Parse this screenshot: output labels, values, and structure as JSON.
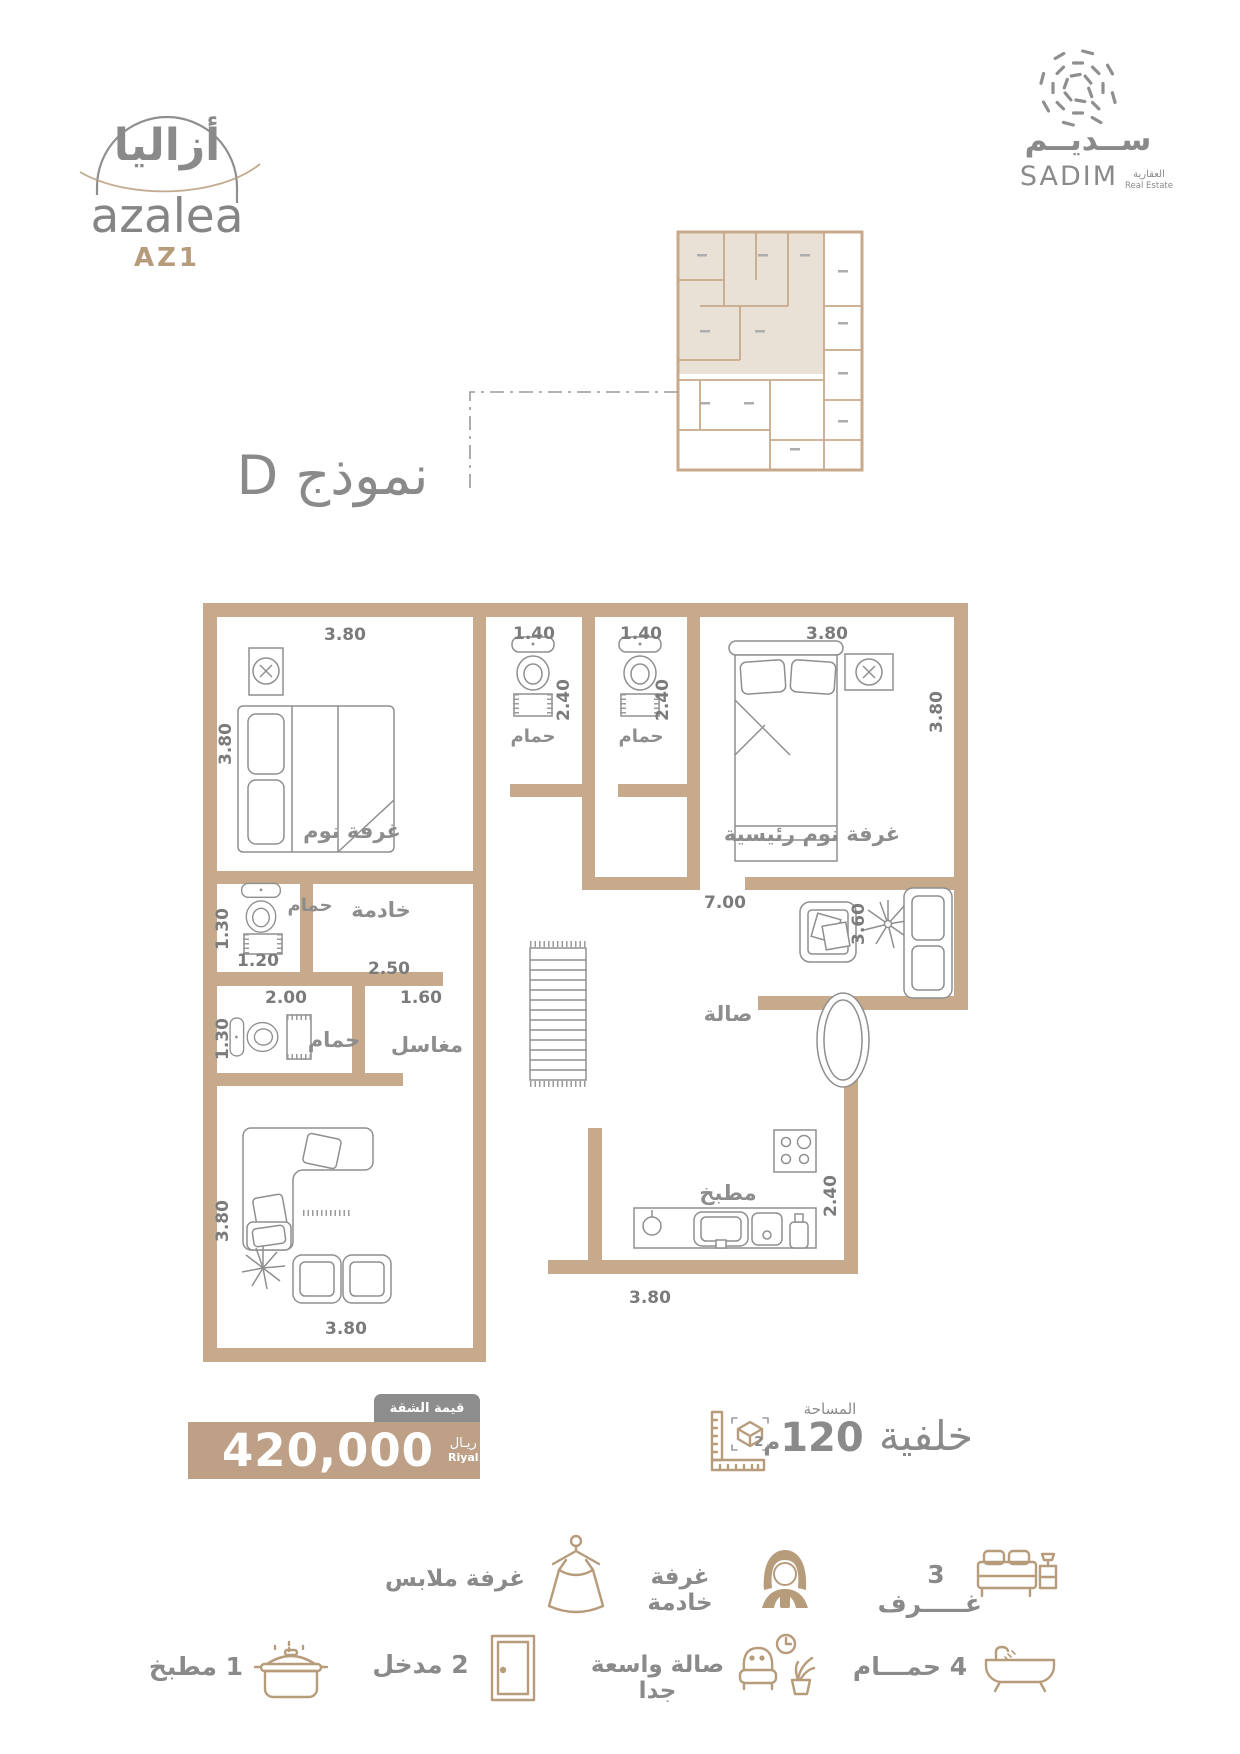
{
  "colors": {
    "wall": "#c7a98b",
    "accent": "#b79c7c",
    "text_gray": "#8a8a8a",
    "highlight": "#e9e1d5",
    "price_bar": "#bda086",
    "tab_gray": "#8d8d8d"
  },
  "brand": {
    "arabic": "أزاليا",
    "name": "azalea",
    "model": "AZ1"
  },
  "developer": {
    "arabic": "ســديــم",
    "name": "SADIM",
    "tagline_ar": "العقارية",
    "tagline_en": "Real Estate"
  },
  "title": "نموذج D",
  "plan": {
    "labels": {
      "bedroom": "غرفة نوم",
      "master_bedroom": "غرفة نوم رئيسية",
      "bathroom": "حمام",
      "maid_room": "خادمة",
      "sinks": "مغاسل",
      "hall": "صالة",
      "kitchen": "مطبخ"
    },
    "dims": {
      "bedroom_w": "3.80",
      "bedroom_h": "3.80",
      "bath1_w": "1.40",
      "bath1_d": "2.40",
      "bath2_w": "1.40",
      "bath2_d": "2.40",
      "master_w": "3.80",
      "master_h": "3.80",
      "hall_w": "7.00",
      "hall_h": "3.60",
      "maidbath_h": "1.30",
      "maidbath_w": "1.20",
      "maid_w": "2.50",
      "bath3_w": "2.00",
      "bath3_h": "1.30",
      "sinks_w": "1.60",
      "living_w": "3.80",
      "living_h": "3.80",
      "kitchen_w": "3.80",
      "kitchen_d": "2.40"
    }
  },
  "price": {
    "tab": "قيمة الشقة",
    "value": "420,000",
    "currency_ar": "ريـال",
    "currency_en": "Riyal"
  },
  "area": {
    "label": "المساحة",
    "value": "120",
    "unit": "م",
    "sup": "2",
    "position": "خلفية"
  },
  "features": {
    "row1": [
      {
        "label": "3 غـــــرف"
      },
      {
        "label": "غرفة خادمة"
      },
      {
        "label": "غرفة ملابس"
      }
    ],
    "row2": [
      {
        "label": "4 حمـــام"
      },
      {
        "label": "صالة واسعة جدا"
      },
      {
        "label": "2 مدخل"
      },
      {
        "label": "1 مطبخ"
      }
    ]
  }
}
